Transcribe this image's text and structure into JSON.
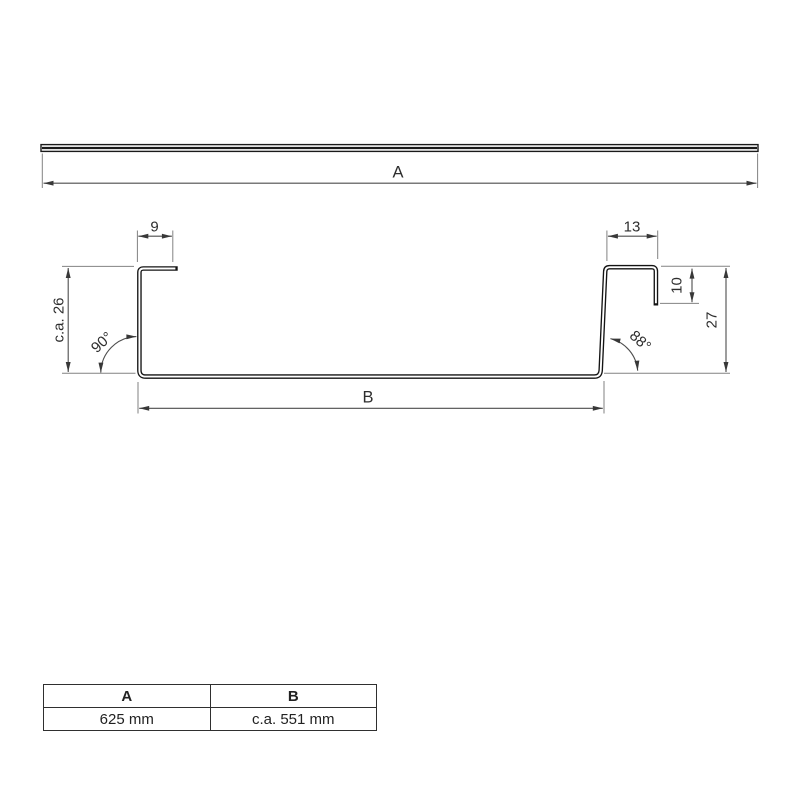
{
  "diagram": {
    "overall_width_label": "A",
    "base_width_label": "B",
    "left_lip_dim": "9",
    "right_flange_dim": "13",
    "left_height_dim": "c.a. 26",
    "right_lip_dim": "10",
    "right_height_dim": "27",
    "left_angle": "90°",
    "right_angle": "88°"
  },
  "table": {
    "headers": [
      "A",
      "B"
    ],
    "values": [
      "625 mm",
      "c.a. 551 mm"
    ]
  },
  "colors": {
    "profile_line": "#141414",
    "dimension_line": "#4d4d4d",
    "extension_line": "#828282",
    "arrow_fill": "#383838"
  }
}
